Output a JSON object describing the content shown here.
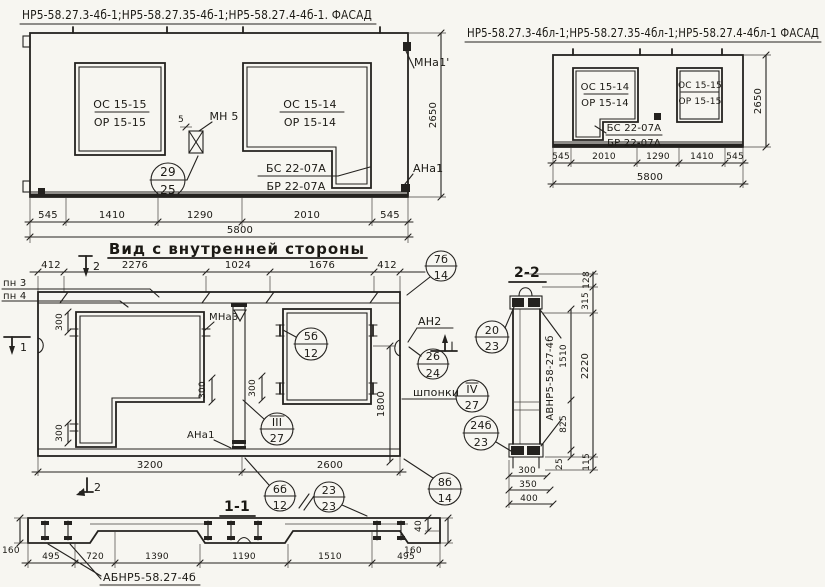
{
  "facade_left": {
    "title": "НР5-58.27.3-4б-1;НР5-58.27.35-4б-1;НР5-58.27.4-4б-1. ФАСАД",
    "window_left_top": "ОС 15-15",
    "window_left_bottom": "ОР 15-15",
    "window_right_top": "ОС 15-14",
    "window_right_bottom": "ОР 15-14",
    "balcony_top": "БС 22-07А",
    "balcony_bottom": "БР 22-07А",
    "mn5_label": "МН 5",
    "mn5_dim": "5",
    "circle_29_n": "29",
    "circle_29_d": "25",
    "label_mna1": "МНа1'",
    "label_ana1": "АНа1",
    "dim_height": "2650",
    "dim_b1": "545",
    "dim_b2": "1410",
    "dim_b3": "1290",
    "dim_b4": "2010",
    "dim_b5": "545",
    "dim_total": "5800"
  },
  "facade_right": {
    "title": "НР5-58.27.3-4бл-1;НР5-58.27.35-4бл-1;НР5-58.27.4-4бл-1 ФАСАД",
    "window_left_top": "ОС 15-14",
    "window_left_bottom": "ОР 15-14",
    "window_right_top": "ОС 15-15",
    "window_right_bottom": "ОР 15-15",
    "balcony_top": "БС 22-07А",
    "balcony_bottom": "БР 22-07А",
    "dim_height": "2650",
    "dim_b1": "545",
    "dim_b2": "2010",
    "dim_b3": "1290",
    "dim_b4": "1410",
    "dim_b5": "545",
    "dim_total": "5800"
  },
  "inner_view": {
    "title": "Вид с внутренней стороны",
    "dim_t1": "412",
    "dim_t2": "2276",
    "dim_t3": "1024",
    "dim_t4": "1676",
    "dim_t5": "412",
    "label_pn3": "пн 3",
    "label_pn4": "пн 4",
    "marker_2": "2",
    "marker_1": "1",
    "label_mna3": "МНа3",
    "label_ana1": "АНа1",
    "label_an2": "АН2",
    "label_shponki": "шпонки",
    "dim_300": "300",
    "dim_1800": "1800",
    "dim_b1": "3200",
    "dim_b2": "2600",
    "circ_7b_n": "7б",
    "circ_7b_d": "14",
    "circ_5b_n": "5б",
    "circ_5b_d": "12",
    "circ_26_n": "26",
    "circ_26_d": "24",
    "circ_iv_n": "IV",
    "circ_iv_d": "27",
    "circ_iii_n": "III",
    "circ_iii_d": "27",
    "circ_24b_n": "24б",
    "circ_24b_d": "23",
    "circ_8b_n": "8б",
    "circ_8b_d": "14",
    "circ_6b_n": "6б",
    "circ_6b_d": "12",
    "circ_23_n": "23",
    "circ_23_d": "23"
  },
  "section22": {
    "title": "2-2",
    "panel_label": "АВНР5-58-27-4б",
    "circ_20_n": "20",
    "circ_20_d": "23",
    "dim_128": "128",
    "dim_315": "315",
    "dim_1510": "1510",
    "dim_2220": "2220",
    "dim_825": "825",
    "dim_25": "25",
    "dim_115": "115",
    "dim_300": "300",
    "dim_350": "350",
    "dim_400": "400"
  },
  "section11": {
    "title": "1-1",
    "label": "АБНР5-58.27-4б",
    "dim_160l": "160",
    "dim_160r": "160",
    "dim_40": "40",
    "dim_1": "495",
    "dim_2": "720",
    "dim_3": "1390",
    "dim_4": "1190",
    "dim_5": "1510",
    "dim_6": "495"
  }
}
